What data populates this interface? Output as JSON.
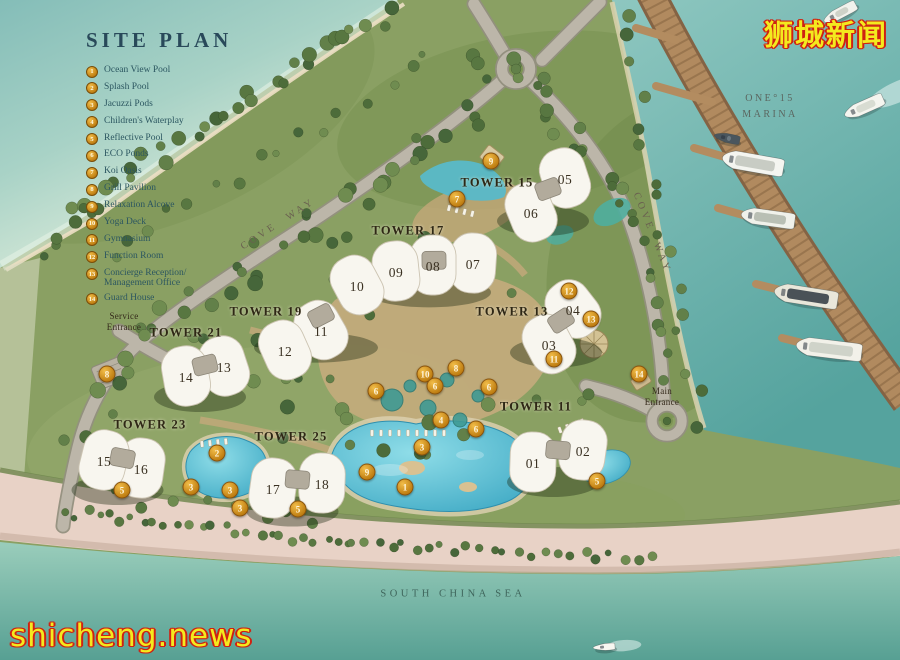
{
  "title": "SITE PLAN",
  "legend": {
    "items": [
      {
        "num": "1",
        "label": "Ocean View Pool"
      },
      {
        "num": "2",
        "label": "Splash Pool"
      },
      {
        "num": "3",
        "label": "Jacuzzi Pods"
      },
      {
        "num": "4",
        "label": "Children's Waterplay"
      },
      {
        "num": "5",
        "label": "Reflective Pool"
      },
      {
        "num": "6",
        "label": "ECO Ponds"
      },
      {
        "num": "7",
        "label": "Koi Oasis"
      },
      {
        "num": "8",
        "label": "Grill Pavilion"
      },
      {
        "num": "9",
        "label": "Relaxation Alcove"
      },
      {
        "num": "10",
        "label": "Yoga Deck"
      },
      {
        "num": "11",
        "label": "Gymnasium"
      },
      {
        "num": "12",
        "label": "Function Room"
      },
      {
        "num": "13",
        "label": "Concierge Reception/ Management Office"
      },
      {
        "num": "14",
        "label": "Guard House"
      }
    ]
  },
  "map": {
    "towers": [
      {
        "label": "TOWER 15",
        "x": 497,
        "y": 183,
        "units": [
          "05",
          "06"
        ]
      },
      {
        "label": "TOWER 17",
        "x": 408,
        "y": 231,
        "units": [
          "07",
          "08",
          "09"
        ]
      },
      {
        "label": "TOWER 19",
        "x": 266,
        "y": 312,
        "units": [
          "10",
          "11",
          "12"
        ]
      },
      {
        "label": "TOWER 21",
        "x": 186,
        "y": 333,
        "units": [
          "13",
          "14"
        ]
      },
      {
        "label": "TOWER 13",
        "x": 512,
        "y": 312,
        "units": [
          "03",
          "04"
        ]
      },
      {
        "label": "TOWER 11",
        "x": 536,
        "y": 407,
        "units": [
          "01",
          "02"
        ]
      },
      {
        "label": "TOWER 23",
        "x": 150,
        "y": 425,
        "units": [
          "15",
          "16"
        ]
      },
      {
        "label": "TOWER 25",
        "x": 291,
        "y": 437,
        "units": [
          "17",
          "18"
        ]
      }
    ],
    "units": [
      {
        "label": "05",
        "x": 565,
        "y": 180,
        "rot": -18
      },
      {
        "label": "06",
        "x": 531,
        "y": 214,
        "rot": -22
      },
      {
        "label": "07",
        "x": 473,
        "y": 265,
        "rot": 4
      },
      {
        "label": "08",
        "x": 433,
        "y": 267,
        "rot": 0
      },
      {
        "label": "09",
        "x": 396,
        "y": 273,
        "rot": -6
      },
      {
        "label": "10",
        "x": 357,
        "y": 287,
        "rot": -28
      },
      {
        "label": "11",
        "x": 321,
        "y": 332,
        "rot": -30
      },
      {
        "label": "12",
        "x": 285,
        "y": 352,
        "rot": -24
      },
      {
        "label": "13",
        "x": 224,
        "y": 368,
        "rot": -18
      },
      {
        "label": "14",
        "x": 186,
        "y": 378,
        "rot": -10
      },
      {
        "label": "04",
        "x": 573,
        "y": 311,
        "rot": -38
      },
      {
        "label": "03",
        "x": 549,
        "y": 346,
        "rot": -28
      },
      {
        "label": "02",
        "x": 583,
        "y": 452,
        "rot": 8
      },
      {
        "label": "01",
        "x": 533,
        "y": 464,
        "rot": 2
      },
      {
        "label": "16",
        "x": 141,
        "y": 470,
        "rot": 8
      },
      {
        "label": "15",
        "x": 104,
        "y": 462,
        "rot": 14
      },
      {
        "label": "18",
        "x": 322,
        "y": 485,
        "rot": 2
      },
      {
        "label": "17",
        "x": 273,
        "y": 490,
        "rot": 8
      }
    ],
    "badges": [
      {
        "num": "9",
        "x": 491,
        "y": 161
      },
      {
        "num": "7",
        "x": 457,
        "y": 199
      },
      {
        "num": "8",
        "x": 456,
        "y": 368
      },
      {
        "num": "10",
        "x": 425,
        "y": 374
      },
      {
        "num": "6",
        "x": 435,
        "y": 386
      },
      {
        "num": "6",
        "x": 376,
        "y": 391
      },
      {
        "num": "6",
        "x": 489,
        "y": 387
      },
      {
        "num": "6",
        "x": 476,
        "y": 429
      },
      {
        "num": "12",
        "x": 569,
        "y": 291
      },
      {
        "num": "13",
        "x": 591,
        "y": 319
      },
      {
        "num": "11",
        "x": 554,
        "y": 359
      },
      {
        "num": "14",
        "x": 639,
        "y": 374
      },
      {
        "num": "4",
        "x": 441,
        "y": 420
      },
      {
        "num": "3",
        "x": 422,
        "y": 447
      },
      {
        "num": "2",
        "x": 217,
        "y": 453
      },
      {
        "num": "3",
        "x": 191,
        "y": 487
      },
      {
        "num": "3",
        "x": 230,
        "y": 490
      },
      {
        "num": "3",
        "x": 240,
        "y": 508
      },
      {
        "num": "5",
        "x": 122,
        "y": 490
      },
      {
        "num": "5",
        "x": 298,
        "y": 509
      },
      {
        "num": "9",
        "x": 367,
        "y": 472
      },
      {
        "num": "1",
        "x": 405,
        "y": 487
      },
      {
        "num": "5",
        "x": 597,
        "y": 481
      },
      {
        "num": "8",
        "x": 107,
        "y": 374
      }
    ],
    "labels": {
      "service_entrance": [
        "Service",
        "Entrance"
      ],
      "main_entrance": [
        "Main",
        "Entrance"
      ],
      "cove_way_left": "COVE WAY",
      "cove_way_right": "COVE WAY",
      "marina": [
        "ONE°15",
        "MARINA"
      ],
      "sea": "SOUTH CHINA SEA"
    },
    "boats": [
      {
        "x": 727,
        "y": 138,
        "len": 26,
        "w": 9,
        "rot": 12,
        "hull": "#4a565e",
        "deck": "#6b7880",
        "wake": false
      },
      {
        "x": 753,
        "y": 163,
        "len": 62,
        "w": 18,
        "rot": 10,
        "hull": "#f4f5f0",
        "deck": "#c8ccc4",
        "wake": false
      },
      {
        "x": 768,
        "y": 218,
        "len": 54,
        "w": 16,
        "rot": 8,
        "hull": "#f0f1ea",
        "deck": "#b9bfb4",
        "wake": false
      },
      {
        "x": 806,
        "y": 296,
        "len": 64,
        "w": 18,
        "rot": 9,
        "hull": "#e9e7da",
        "deck": "#4a5257",
        "wake": false
      },
      {
        "x": 829,
        "y": 349,
        "len": 66,
        "w": 18,
        "rot": 7,
        "hull": "#f2f1e9",
        "deck": "#cfd3c9",
        "wake": false
      },
      {
        "x": 864,
        "y": 107,
        "len": 42,
        "w": 13,
        "rot": -24,
        "hull": "#f5f5ef",
        "deck": "#d8dcd2",
        "wake": true
      },
      {
        "x": 840,
        "y": 13,
        "len": 36,
        "w": 11,
        "rot": -28,
        "hull": "#f1f2ec",
        "deck": "#ced2c8",
        "wake": false
      },
      {
        "x": 604,
        "y": 647,
        "len": 22,
        "w": 7,
        "rot": -4,
        "hull": "#f7f7f1",
        "deck": "#dde0d6",
        "wake": true
      }
    ]
  },
  "watermarks": {
    "top_right": "狮城新闻",
    "bottom_left": "shicheng.news"
  },
  "colors": {
    "badge_gold": "#c8860f",
    "title_teal": "#29495a",
    "legend_text": "#2b5660",
    "watermark_yellow": "#f4ea1e",
    "watermark_red": "#cf2213"
  }
}
